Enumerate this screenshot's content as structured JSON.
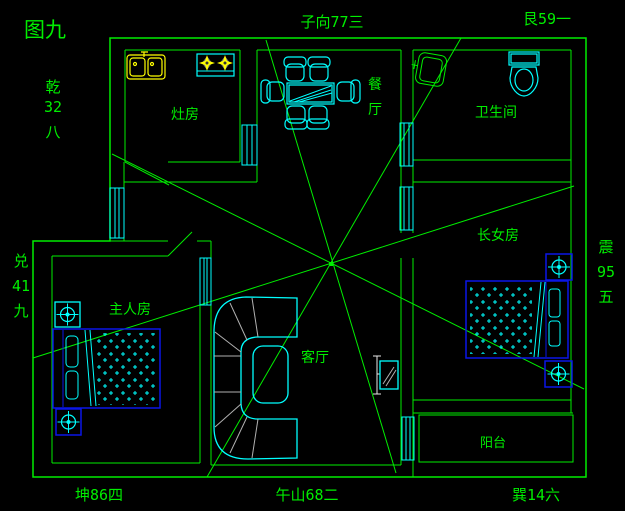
{
  "figure_title": "图九",
  "colors": {
    "background": "#000000",
    "cad_green": "#00ee00",
    "cad_cyan": "#00ffff",
    "cad_blue": "#0a16e8",
    "cad_yellow": "#ffff00",
    "cad_gray": "#b0b0b0",
    "cad_white": "#e8e8e8"
  },
  "compass": {
    "nw": {
      "chars": [
        "乾",
        "32",
        "八"
      ]
    },
    "n": {
      "text": "子向77三"
    },
    "ne": {
      "text": "艮59一"
    },
    "e": {
      "chars": [
        "震",
        "95",
        "五"
      ]
    },
    "se": {
      "text": "巽14六"
    },
    "s": {
      "text": "午山68二"
    },
    "sw": {
      "text": "坤86四"
    },
    "w": {
      "chars": [
        "兑",
        "41",
        "九"
      ]
    }
  },
  "rooms": {
    "kitchen": {
      "label": "灶房"
    },
    "dining": {
      "chars": [
        "餐",
        "厅"
      ]
    },
    "bathroom": {
      "label": "卫生间"
    },
    "daughter_bedroom": {
      "label": "长女房"
    },
    "master_bedroom": {
      "label": "主人房"
    },
    "living_room": {
      "label": "客厅"
    },
    "balcony": {
      "label": "阳台"
    }
  }
}
